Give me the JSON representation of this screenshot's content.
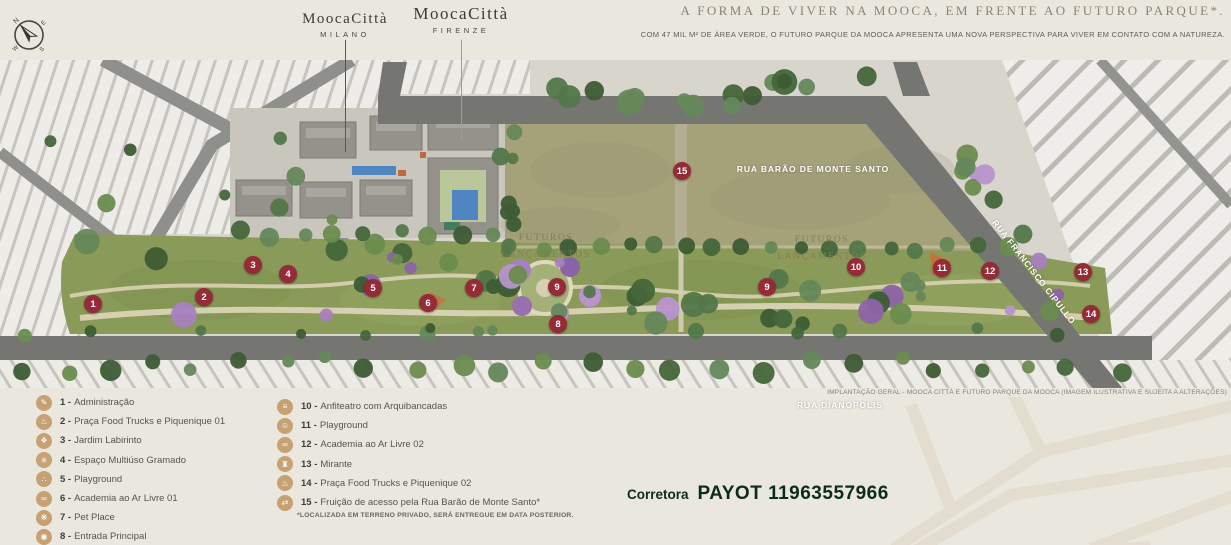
{
  "header": {
    "compass": {
      "icon": "compass-icon",
      "directions": [
        "N",
        "E",
        "S",
        "W"
      ]
    },
    "logos": [
      {
        "brand": "MoocaCittà",
        "variant": "MILANO"
      },
      {
        "brand": "MoocaCittà",
        "variant": "FIRENZE"
      }
    ],
    "headline": "A FORMA DE VIVER NA MOOCA, EM FRENTE AO FUTURO PARQUE*.",
    "subheadline": "COM 47 MIL M² DE ÁREA VERDE, O FUTURO PARQUE DA MOOCA APRESENTA UMA NOVA PERSPECTIVA PARA VIVER EM CONTATO COM A NATUREZA."
  },
  "map": {
    "streets": {
      "top": "RUA BARÃO DE MONTE SANTO",
      "right": "RUA FRANCISCO CIPULLO",
      "bottom": "RUA DIANÓPOLIS"
    },
    "future_lots": {
      "line1": "FUTUROS",
      "line2": "LANÇAMENTOS"
    },
    "markers": [
      {
        "n": "1",
        "x": 93,
        "y": 304
      },
      {
        "n": "2",
        "x": 204,
        "y": 297
      },
      {
        "n": "3",
        "x": 253,
        "y": 265
      },
      {
        "n": "4",
        "x": 288,
        "y": 274
      },
      {
        "n": "5",
        "x": 373,
        "y": 288
      },
      {
        "n": "6",
        "x": 428,
        "y": 303
      },
      {
        "n": "7",
        "x": 474,
        "y": 288
      },
      {
        "n": "8",
        "x": 558,
        "y": 324
      },
      {
        "n": "9",
        "x": 557,
        "y": 287
      },
      {
        "n": "9",
        "x": 767,
        "y": 287
      },
      {
        "n": "10",
        "x": 856,
        "y": 267
      },
      {
        "n": "11",
        "x": 942,
        "y": 268
      },
      {
        "n": "12",
        "x": 990,
        "y": 271
      },
      {
        "n": "13",
        "x": 1083,
        "y": 272
      },
      {
        "n": "14",
        "x": 1091,
        "y": 314
      },
      {
        "n": "15",
        "x": 682,
        "y": 171
      }
    ],
    "caption": "IMPLANTAÇÃO GERAL - MOOCA CITTÀ E FUTURO PARQUE DA MOOCA (IMAGEM ILUSTRATIVA E SUJEITA A ALTERAÇÕES)"
  },
  "legend": {
    "col1": [
      {
        "num": "1",
        "label": "Administração",
        "icon": "clipboard-icon",
        "glyph": "✎"
      },
      {
        "num": "2",
        "label": "Praça Food Trucks e Piquenique 01",
        "icon": "food-truck-icon",
        "glyph": "♨"
      },
      {
        "num": "3",
        "label": "Jardim Labirinto",
        "icon": "maze-icon",
        "glyph": "❖"
      },
      {
        "num": "4",
        "label": "Espaço Multiúso Gramado",
        "icon": "multiuse-lawn-icon",
        "glyph": "✳"
      },
      {
        "num": "5",
        "label": "Playground",
        "icon": "playground-icon",
        "glyph": "∴"
      },
      {
        "num": "6",
        "label": "Academia ao Ar Livre 01",
        "icon": "dumbbell-icon",
        "glyph": "∞"
      },
      {
        "num": "7",
        "label": "Pet Place",
        "icon": "pet-paw-icon",
        "glyph": "❋"
      },
      {
        "num": "8",
        "label": "Entrada Principal",
        "icon": "entrance-pin-icon",
        "glyph": "◉"
      }
    ],
    "col2": [
      {
        "num": "10",
        "label": "Anfiteatro com Arquibancadas",
        "icon": "amphitheater-icon",
        "glyph": "≡"
      },
      {
        "num": "11",
        "label": "Playground",
        "icon": "playground-icon",
        "glyph": "☺"
      },
      {
        "num": "12",
        "label": "Academia ao Ar Livre 02",
        "icon": "dumbbell-icon",
        "glyph": "∞"
      },
      {
        "num": "13",
        "label": "Mirante",
        "icon": "lookout-tower-icon",
        "glyph": "♜"
      },
      {
        "num": "14",
        "label": "Praça Food Trucks e Piquenique 02",
        "icon": "food-truck-icon",
        "glyph": "♨"
      },
      {
        "num": "15",
        "label": "Fruição de acesso pela Rua Barão de Monte Santo*",
        "icon": "access-arrows-icon",
        "glyph": "⇄"
      }
    ],
    "footnote": "*LOCALIZADA EM TERRENO PRIVADO, SERÁ ENTREGUE EM DATA POSTERIOR."
  },
  "watermark": {
    "prefix": "Corretora",
    "name_number": "PAYOT 11963557966"
  },
  "colors": {
    "marker_red": "#942b36",
    "legend_icon_tan": "#c6a273",
    "leader_tan": "#b59a6a",
    "headline_gray": "#8b8577",
    "watermark_dark": "#0d2b16",
    "park_green": "#8a9a58",
    "future_field_khaki": "#a5a27a",
    "road_gray": "#757572"
  }
}
